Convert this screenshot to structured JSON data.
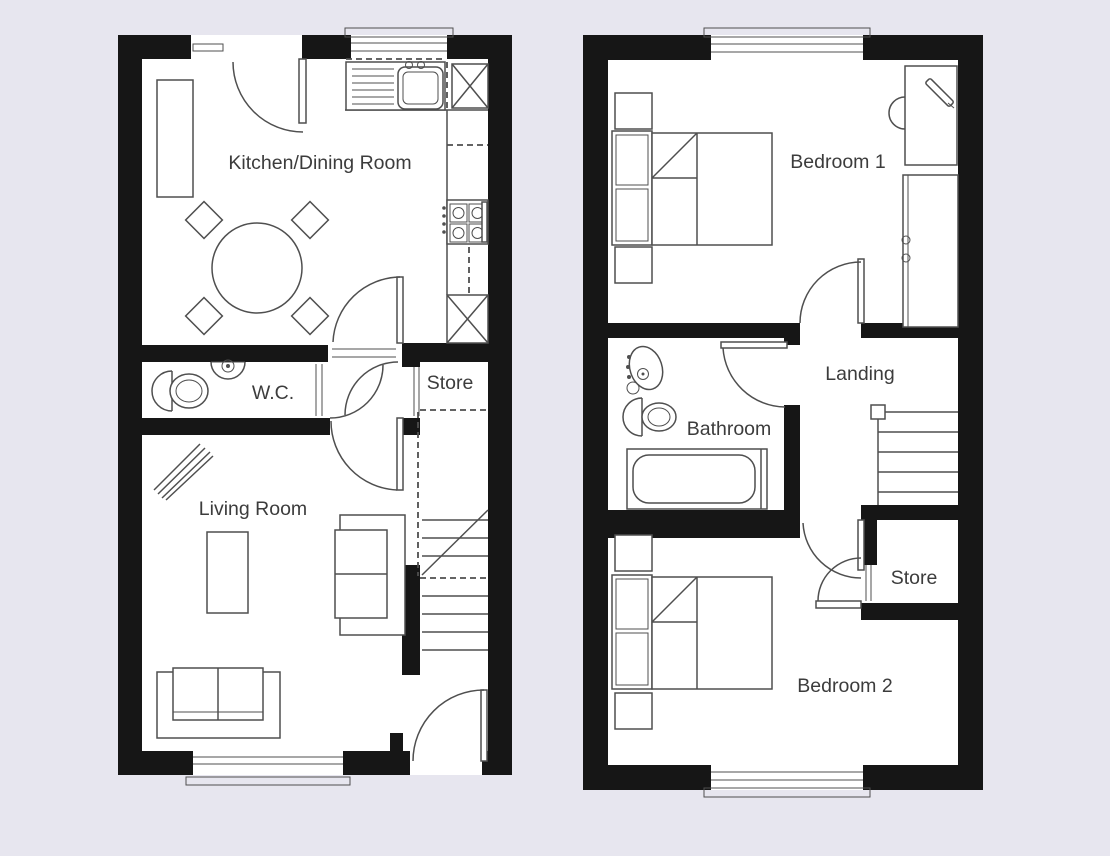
{
  "colors": {
    "background": "#e7e6ef",
    "wall": "#161616",
    "line": "#4f4f4f",
    "text": "#3c3c3c",
    "floor": "#ffffff"
  },
  "ground_floor": {
    "labels": {
      "kitchen_dining": "Kitchen/Dining Room",
      "wc": "W.C.",
      "store": "Store",
      "living": "Living Room"
    }
  },
  "first_floor": {
    "labels": {
      "bedroom1": "Bedroom 1",
      "landing": "Landing",
      "bathroom": "Bathroom",
      "store": "Store",
      "bedroom2": "Bedroom 2"
    }
  }
}
